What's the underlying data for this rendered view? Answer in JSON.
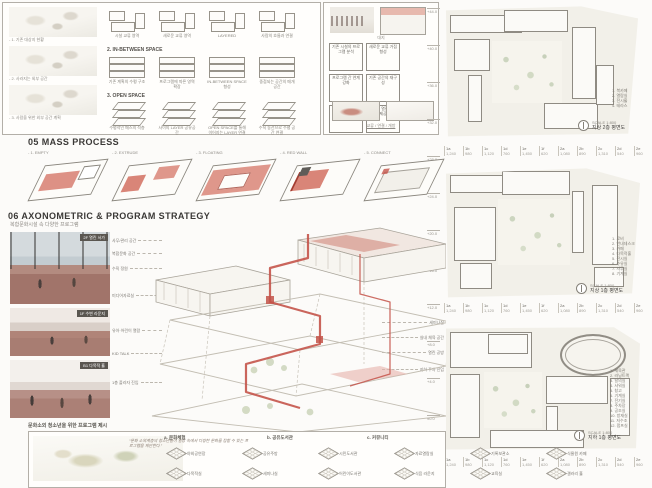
{
  "sections": {
    "s05_title": "05 MASS PROCESS",
    "s06_title": "06 AXONOMETRIC & PROGRAM STRATEGY",
    "s06_subtitle": "복합문화시설 속 다양한 프로그램",
    "program_caption": "문화소외 청소년을 위한 프로그램 제시"
  },
  "panel_a": {
    "sketches": [
      {
        "caption": "- 1. 기존 대상지 현황"
      },
      {
        "caption": "- 2. 사라지는 외부 공간"
      },
      {
        "caption": "- 3. 사람을 위한 외부 공간 계획"
      }
    ],
    "row1_cells": [
      {
        "caption": "시설 교류 영역"
      },
      {
        "caption": "새로운 교류 영역"
      },
      {
        "caption": "LAYERED"
      },
      {
        "caption": "사람의 흐름과 연결"
      }
    ],
    "row2_header": "2. IN-BETWEEN SPACE",
    "row2_cells": [
      {
        "caption": "기존 계획의 수평 구조"
      },
      {
        "caption": "프로그램에 따른 영역 확장"
      },
      {
        "caption": "IN-BETWEEN SPACE 형성"
      },
      {
        "caption": "중첩되는 공간의 매개 공간"
      }
    ],
    "row3_header": "3. OPEN SPACE",
    "row3_cells": [
      {
        "caption": "수평적인 매스의 적층"
      },
      {
        "caption": "사이의 LAYER 공유공간"
      },
      {
        "caption": "OPEN SPACE를 통해 이어지는 LAYER 연결"
      },
      {
        "caption": "수직 동선으로 수평 공간 연결"
      }
    ]
  },
  "panel_b": {
    "top_caption": "대지",
    "flow_boxes": [
      "기존 시설의 프로그램 분석",
      "새로운 교류 거점 형성",
      "프로그램 간 연계 강화",
      "기존 공간의 재구성",
      "수직·수평 동선의 연결",
      "지역에 열린 공간 제공"
    ],
    "bottom_caption": "교류 / 연결 / 개방"
  },
  "mass_process": {
    "steps": [
      {
        "label": "- 1. EMPTY"
      },
      {
        "label": "- 2. EXTRUDE"
      },
      {
        "label": "- 3. FLOATING"
      },
      {
        "label": "- 4. RED WALL"
      },
      {
        "label": "- 5. CONNECT"
      }
    ]
  },
  "levels": [
    "+44.0",
    "+40.0",
    "+36.0",
    "+32.0",
    "+28.0",
    "+24.0",
    "+20.0",
    "+16.0",
    "+12.0",
    "+8.0",
    "+4.0",
    "±0.0"
  ],
  "renders": [
    {
      "caption": "2F 열린 서가"
    },
    {
      "caption": "1F 수변 라운지"
    },
    {
      "caption": "B1 다목적 홀"
    }
  ],
  "axon": {
    "left_labels": [
      "사무/관리 공간",
      "복합문화 공간",
      "수직 정원",
      "미디어자료실",
      "유아·어린이 열람",
      "KID TALK",
      "1층 플라자 진입"
    ],
    "right_labels": [
      "수변과 수직 연결 공간",
      "다목적 체험 공간",
      "세미나실",
      "실내 체육 공간",
      "열린 공방",
      "지하 주차 진입"
    ]
  },
  "program_panel": {
    "quote": "“문화 소외계층의 청소년들이 일상 속에서 다양한 문화를 접할 수 있는 프로그램을 제안한다.”",
    "groups": [
      "a. 문화체험",
      "b. 공유도서관",
      "c. 커뮤니티"
    ],
    "items_row1": [
      {
        "label": "야외공연장"
      },
      {
        "label": "공유주방"
      },
      {
        "label": "시민도서관"
      },
      {
        "label": "자료열람실"
      },
      {
        "label": "기록보관소"
      },
      {
        "label": "식물원 카페"
      }
    ],
    "items_row2": [
      {
        "label": "다목적실"
      },
      {
        "label": "세미나실"
      },
      {
        "label": "어린이도서관"
      },
      {
        "label": "식음 라운지"
      },
      {
        "label": "교육실"
      },
      {
        "label": "갤러리 홀"
      }
    ]
  },
  "plans": [
    {
      "caption": "지상 2층 평면도",
      "scale": "SCALE 1:800",
      "notes": [
        "1. 북카페",
        "2. 열람실",
        "3. 전시홀",
        "4. 테라스"
      ]
    },
    {
      "caption": "지상 1층 평면도",
      "scale": "SCALE 1:800",
      "notes": [
        "1. 로비",
        "2. 안내데스크",
        "3. 카페",
        "4. 다목적홀",
        "5. 전시실",
        "6. 수유실",
        "7. 사무실",
        "8. 기계실"
      ]
    },
    {
      "caption": "지하 1층 평면도",
      "scale": "SCALE 1:800",
      "notes": [
        "1. 체육관",
        "2. 러닝트랙",
        "3. 탈의실",
        "4. 샤워실",
        "5. 창고",
        "6. 기계실",
        "7. 전기실",
        "8. 주차장",
        "9. 공조실",
        "10. 방재실",
        "11. 저수조",
        "12. 펌프실"
      ]
    }
  ],
  "legend_row": {
    "items": [
      {
        "label": "1a",
        "value": "1,240"
      },
      {
        "label": "1b",
        "value": "980"
      },
      {
        "label": "1c",
        "value": "1,120"
      },
      {
        "label": "1d",
        "value": "760"
      },
      {
        "label": "1e",
        "value": "1,450"
      },
      {
        "label": "1f",
        "value": "620"
      },
      {
        "label": "2a",
        "value": "1,080"
      },
      {
        "label": "2b",
        "value": "890"
      },
      {
        "label": "2c",
        "value": "1,310"
      },
      {
        "label": "2d",
        "value": "540"
      },
      {
        "label": "2e",
        "value": "960"
      },
      {
        "label": "2f",
        "value": "1,150"
      }
    ]
  }
}
